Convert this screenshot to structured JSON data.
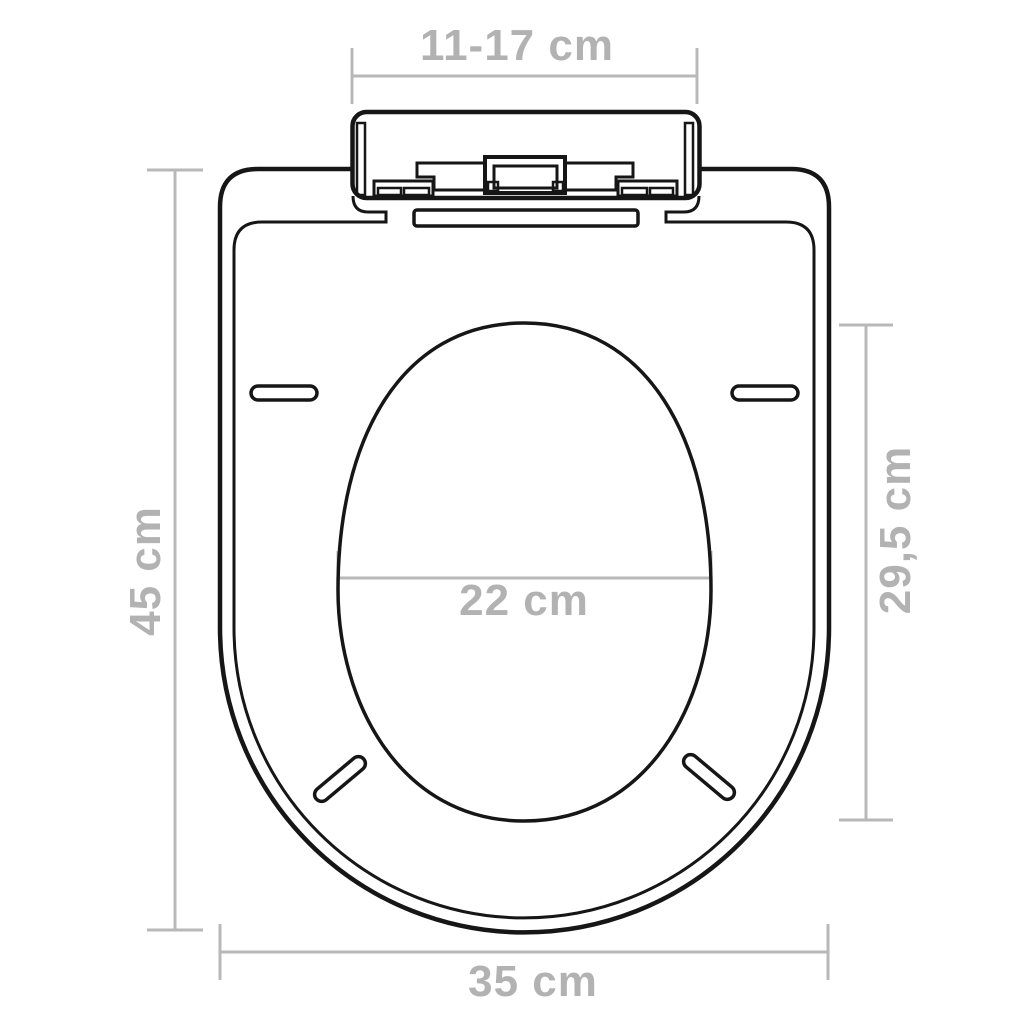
{
  "colors": {
    "outline": "#161616",
    "dimension_lines": "#b8b8b8",
    "dimension_text": "#b2b2b2",
    "background": "#ffffff"
  },
  "diagram": {
    "type": "technical-drawing",
    "subject": "toilet seat with soft-close hinge, top view",
    "dimensions": {
      "hinge_span": {
        "label": "11-17 cm",
        "position": "top"
      },
      "total_length": {
        "label": "45 cm",
        "position": "left"
      },
      "inner_length": {
        "label": "29,5 cm",
        "position": "right"
      },
      "hole_width": {
        "label": "22 cm",
        "position": "center"
      },
      "total_width": {
        "label": "35 cm",
        "position": "bottom"
      }
    }
  }
}
